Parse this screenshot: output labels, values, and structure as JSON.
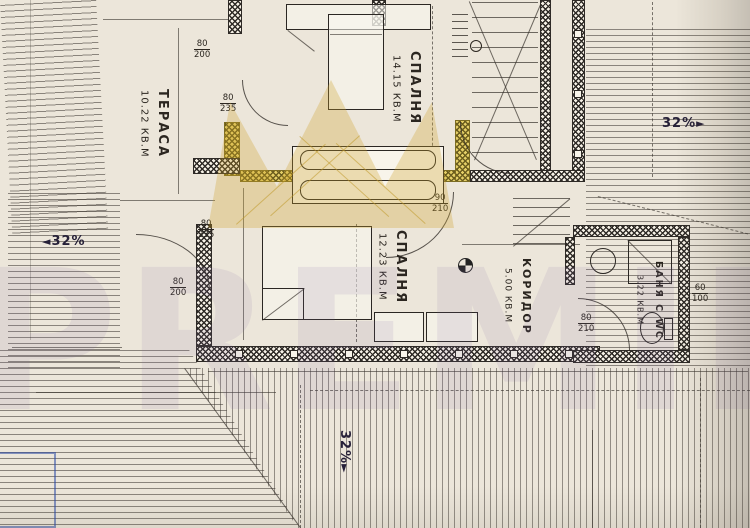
{
  "watermark": {
    "brand": "PREMIER",
    "crown_color": "#cea32c"
  },
  "rooms": [
    {
      "name": "ТЕРАСА",
      "area": "10.22 КВ.М"
    },
    {
      "name": "СПАЛНЯ",
      "area": "14.15 КВ.М"
    },
    {
      "name": "СПАЛНЯ",
      "area": "12.23 КВ.М"
    },
    {
      "name": "КОРИДОР",
      "area": "5.00 КВ.М"
    },
    {
      "name": "БАНЯ С WC",
      "area": "3.22 КВ.М"
    }
  ],
  "stair_note": {
    "steps": "18 ст.",
    "riser_tread": "15,8/28"
  },
  "level_mark": "+2.84",
  "slopes": [
    {
      "t": "32%",
      "arrow_right": "►",
      "x": 662,
      "y": 116
    },
    {
      "t": "32%",
      "arrow_left": "◄",
      "x": 42,
      "y": 234
    },
    {
      "t": "32%",
      "arrow_right": "►",
      "x": 352,
      "y": 430,
      "rot": 90
    }
  ],
  "dims": [
    {
      "t": "180",
      "x": 150,
      "y": 10
    },
    {
      "t": "314.5",
      "x": 172,
      "y": 52,
      "rot": 90
    },
    {
      "t": "645",
      "x": 122,
      "y": 150,
      "rot": -78
    },
    {
      "t": "0.5",
      "x": 236,
      "y": 12,
      "rot": 90
    },
    {
      "t": "80",
      "x": 246,
      "y": 46,
      "rot": 90
    },
    {
      "t": "70",
      "x": 240,
      "y": 138,
      "rot": 50
    },
    {
      "t": "375",
      "x": 303,
      "y": 141
    },
    {
      "t": "300.5",
      "x": 428,
      "y": 68,
      "rot": 90
    },
    {
      "t": "90",
      "x": 470,
      "y": 141
    },
    {
      "t": "210",
      "x": 466,
      "y": 156,
      "rot": 90
    },
    {
      "t": "90",
      "x": 514,
      "y": 3
    },
    {
      "t": "18 ст.",
      "x": 489,
      "y": 18,
      "rot": 72
    },
    {
      "t": "15,8/28",
      "x": 516,
      "y": 58,
      "rot": 78
    },
    {
      "t": "265",
      "x": 554,
      "y": 64,
      "rot": 90
    },
    {
      "t": "422",
      "x": 542,
      "y": 104,
      "rot": 90
    },
    {
      "t": "90",
      "x": 538,
      "y": 132,
      "rot": 45
    },
    {
      "t": "465",
      "x": 636,
      "y": 76,
      "rot": 86
    },
    {
      "t": "100",
      "x": 589,
      "y": 166
    },
    {
      "t": "80",
      "x": 587,
      "y": 179
    },
    {
      "t": "130",
      "x": 144,
      "y": 191
    },
    {
      "t": "545",
      "x": 94,
      "y": 194,
      "rot": 84
    },
    {
      "t": "110",
      "x": 20,
      "y": 260,
      "rot": 90
    },
    {
      "t": "169",
      "x": 54,
      "y": 334
    },
    {
      "t": "350.5",
      "x": 176,
      "y": 248,
      "rot": 90
    },
    {
      "t": "70",
      "x": 243,
      "y": 190,
      "rot": 60
    },
    {
      "t": "80",
      "x": 245,
      "y": 230,
      "rot": 90
    },
    {
      "t": "80",
      "x": 245,
      "y": 274,
      "rot": 90
    },
    {
      "t": "70.5",
      "x": 242,
      "y": 318,
      "rot": 78
    },
    {
      "t": "300.5",
      "x": 350,
      "y": 254,
      "rot": 90
    },
    {
      "t": "407",
      "x": 321,
      "y": 316
    },
    {
      "t": "100",
      "x": 468,
      "y": 238
    },
    {
      "t": "90",
      "x": 534,
      "y": 238
    },
    {
      "t": "107.5",
      "x": 492,
      "y": 194,
      "rot": 90
    },
    {
      "t": "Н=100 см",
      "x": 549,
      "y": 160,
      "rot": 84,
      "fs": 7
    },
    {
      "t": "250",
      "x": 549,
      "y": 262,
      "rot": 90
    },
    {
      "t": "193",
      "x": 488,
      "y": 284,
      "rot": 90
    },
    {
      "t": "204",
      "x": 497,
      "y": 317
    },
    {
      "t": "+2.84",
      "x": 461,
      "y": 272,
      "rot": 70
    },
    {
      "t": "175",
      "x": 628,
      "y": 205
    },
    {
      "t": "110",
      "x": 589,
      "y": 254,
      "rot": 90
    },
    {
      "t": "⌀76",
      "x": 652,
      "y": 242,
      "rot": 72
    },
    {
      "t": "200",
      "x": 628,
      "y": 281,
      "rot": 90
    },
    {
      "t": "161",
      "x": 618,
      "y": 319
    },
    {
      "t": "⌀64",
      "x": 650,
      "y": 325,
      "rot": 72
    },
    {
      "t": "115",
      "x": 704,
      "y": 342
    },
    {
      "t": "226",
      "x": 178,
      "y": 365
    },
    {
      "t": "396",
      "x": 128,
      "y": 386
    },
    {
      "t": "794",
      "x": 466,
      "y": 373
    },
    {
      "t": "395",
      "x": 576,
      "y": 462,
      "rot": 86
    }
  ],
  "door_labels": [
    {
      "top": "80",
      "bottom": "200",
      "x": 194,
      "y": 40
    },
    {
      "top": "80",
      "bottom": "235",
      "x": 220,
      "y": 94
    },
    {
      "top": "80",
      "bottom": "235",
      "x": 198,
      "y": 220
    },
    {
      "top": "80",
      "bottom": "200",
      "x": 170,
      "y": 278
    },
    {
      "top": "90",
      "bottom": "210",
      "x": 432,
      "y": 194
    },
    {
      "top": "80",
      "bottom": "210",
      "x": 578,
      "y": 314
    },
    {
      "top": "60",
      "bottom": "100",
      "x": 692,
      "y": 284
    }
  ]
}
